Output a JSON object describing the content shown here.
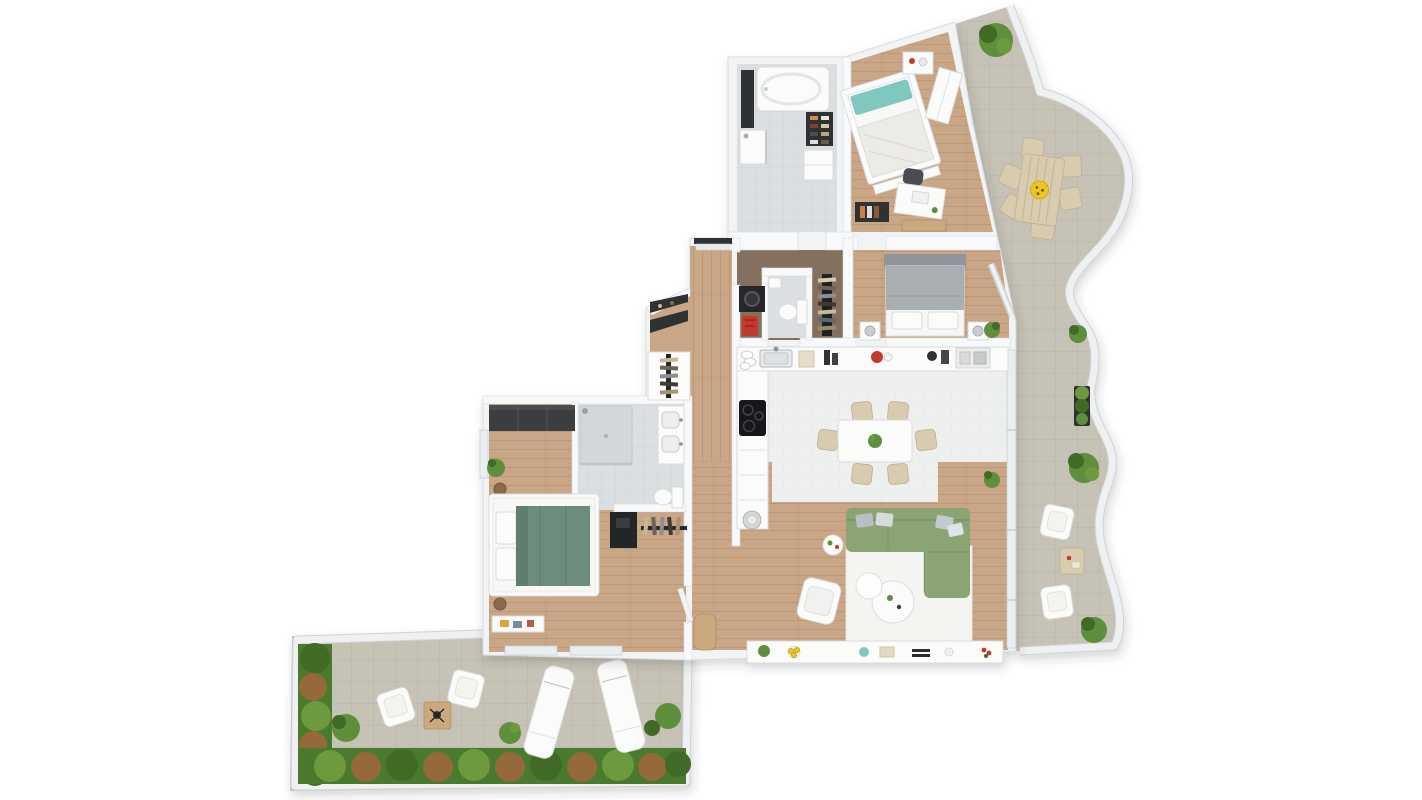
{
  "meta": {
    "title": "Top-down 3D apartment floor plan render with two terraces",
    "canvas": {
      "width": 1422,
      "height": 800
    }
  },
  "palette": {
    "bg": "#ffffff",
    "wall": "#f2f3f5",
    "wall2": "#f8f9fa",
    "wall_edge": "#d8dbde",
    "wood": "#c9a685",
    "wood_dark": "#83705f",
    "tile_white": "#eef0ef",
    "tile_gray": "#dcdfe1",
    "terrace_tile": "#c7c2b6",
    "balustrade": "#eef0f2",
    "glass": "#e9eef1",
    "furniture_white": "#fbfbfa",
    "furniture_stroke": "#d9dbde",
    "tan": "#d8cbae",
    "tan_stroke": "#bdb092",
    "wood_furn": "#caa97e",
    "dark": "#2e3033",
    "sofa_green": "#8ba473",
    "bed_green": "#6c8d7b",
    "teal": "#7ec8c0",
    "bed_gray": "#a9aeb3",
    "headboard_gray": "#8f959b",
    "yellow": "#e9c722",
    "red": "#c5392e",
    "plant": "#5d8f3c",
    "plant_dark": "#3f6b28",
    "plant_light": "#6d9a3c",
    "palm_brown": "#96693b",
    "hedge_base": "#4a7a2d"
  },
  "rooms": [
    {
      "label": "Bathroom (top)",
      "floor": "grey tile",
      "items": [
        "bathtub",
        "tall dark cabinet",
        "shower",
        "shoe shelf",
        "low cabinet"
      ]
    },
    {
      "label": "Bedroom 2",
      "floor": "oak parquet",
      "items": [
        "double bed with teal pillow",
        "nightstand",
        "desk with laptop",
        "desk chair",
        "dark bookshelf",
        "wood bench",
        "white wardrobe"
      ]
    },
    {
      "label": "Master bedroom",
      "floor": "oak parquet",
      "items": [
        "double bed grey duvet",
        "two nightstands with lamps",
        "corner plant"
      ]
    },
    {
      "label": "Guest WC",
      "floor": "dark wood / tile",
      "items": [
        "washing machine",
        "toilet",
        "small washbasin",
        "red utility trolley"
      ]
    },
    {
      "label": "Walk-in closet",
      "floor": "dark wood",
      "items": [
        "double clothes rail"
      ]
    },
    {
      "label": "Kitchen",
      "floor": "white tile",
      "items": [
        "counter with sink",
        "dish rack",
        "induction cooktop",
        "cabinet column",
        "red kettle",
        "coffee station",
        "round trash bin"
      ]
    },
    {
      "label": "Dining area",
      "floor": "white tile",
      "items": [
        "white table",
        "six beige chairs",
        "plant centerpiece"
      ]
    },
    {
      "label": "Living room",
      "floor": "oak parquet",
      "items": [
        "green corner sofa",
        "white rug",
        "two round coffee tables",
        "white armchair",
        "round side table",
        "long sideboard with plant, lemons, dish, book, remote, cup, flowers",
        "floor plant",
        "wooden stool"
      ]
    },
    {
      "label": "Entrance hall",
      "floor": "oak parquet",
      "items": [
        "entry door",
        "black coat rack",
        "open wardrobe with hangers"
      ]
    },
    {
      "label": "Bedroom 1",
      "floor": "oak parquet",
      "items": [
        "double bed green duvet",
        "dark wardrobe",
        "round nightstands",
        "corner plant",
        "bench tray with books",
        "black dressing vanity",
        "open clothes rail"
      ]
    },
    {
      "label": "En-suite bathroom",
      "floor": "grey tile",
      "items": [
        "walk-in shower",
        "double vanity",
        "toilet"
      ]
    },
    {
      "label": "East terrace",
      "floor": "stone tile",
      "items": [
        "outdoor dining table",
        "six outdoor chairs",
        "yellow flower centerpiece",
        "two lounge armchairs",
        "outdoor side table",
        "dark planter",
        "shrubs",
        "large plant"
      ]
    },
    {
      "label": "South terrace",
      "floor": "stone tile",
      "items": [
        "two white armchairs",
        "wooden cube table",
        "two sun loungers",
        "potted plants",
        "planted palm hedge"
      ]
    }
  ]
}
